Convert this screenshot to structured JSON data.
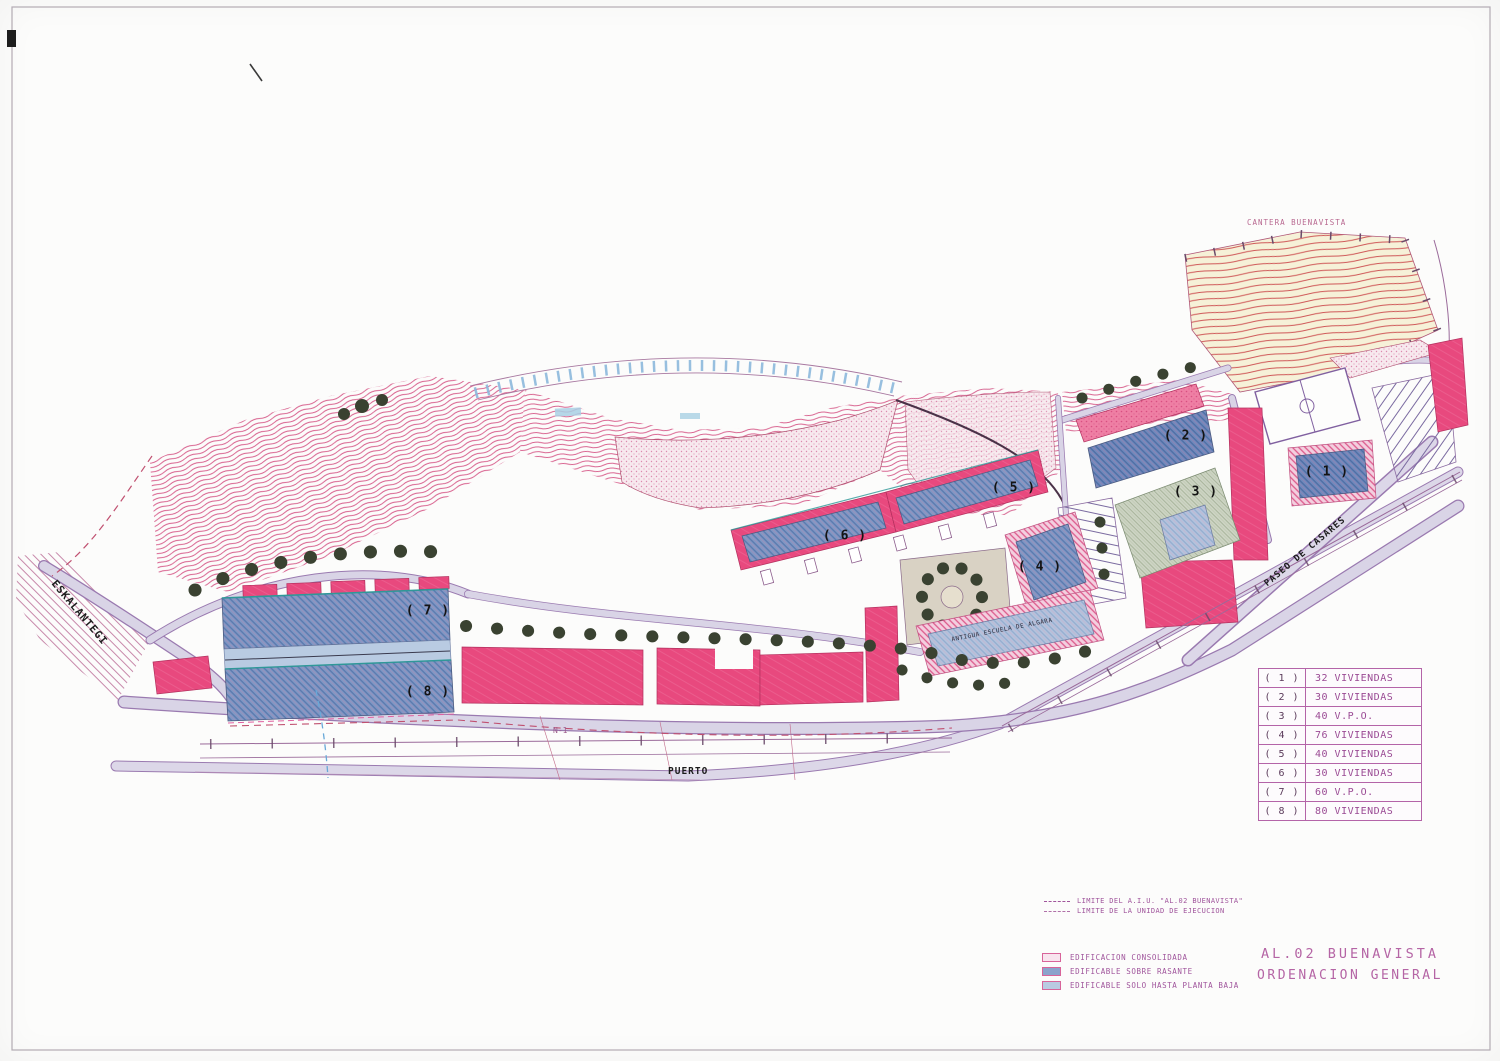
{
  "sheet": {
    "title_line1": "AL.02 BUENAVISTA",
    "title_line2": "ORDENACION GENERAL"
  },
  "map_labels": {
    "cantera_buenavista": "CANTERA BUENAVISTA",
    "eskalantegi": "ESKALANTEGI",
    "paseo_de_casares": "PASEO DE CASARES",
    "puerto": "PUERTO",
    "road_n1": "N-1",
    "building_label": "ANTIGUA ESCUELA DE ALGARA"
  },
  "markers": [
    {
      "label": "( 1 )"
    },
    {
      "label": "( 2 )"
    },
    {
      "label": "( 3 )"
    },
    {
      "label": "( 4 )"
    },
    {
      "label": "( 5 )"
    },
    {
      "label": "( 6 )"
    },
    {
      "label": "( 7 )"
    },
    {
      "label": "( 8 )"
    }
  ],
  "units_table": {
    "rows": [
      {
        "num": "( 1 )",
        "value": "32 VIVIENDAS"
      },
      {
        "num": "( 2 )",
        "value": "30 VIVIENDAS"
      },
      {
        "num": "( 3 )",
        "value": "40 V.P.O."
      },
      {
        "num": "( 4 )",
        "value": "76 VIVIENDAS"
      },
      {
        "num": "( 5 )",
        "value": "40 VIVIENDAS"
      },
      {
        "num": "( 6 )",
        "value": "30 VIVIENDAS"
      },
      {
        "num": "( 7 )",
        "value": "60 V.P.O."
      },
      {
        "num": "( 8 )",
        "value": "80 VIVIENDAS"
      }
    ]
  },
  "line_legend": [
    {
      "label": "LIMITE DEL A.I.U. \"AL.02 BUENAVISTA\""
    },
    {
      "label": "LIMITE DE LA UNIDAD DE EJECUCION"
    }
  ],
  "fill_legend": [
    {
      "label": "EDIFICACION CONSOLIDADA",
      "swatch": "#f8e4ee"
    },
    {
      "label": "EDIFICABLE SOBRE RASANTE",
      "swatch": "#8ba3cc"
    },
    {
      "label": "EDIFICABLE SOLO HASTA PLANTA BAJA",
      "swatch": "#b9cbe2"
    }
  ],
  "colors": {
    "consolidated_building": "#e8497e",
    "buildable_block": "#7e98c4",
    "buildable_ground_floor": "#b9cbe2",
    "contour_line": "#d8618e",
    "quarry_line": "#cf5858",
    "road_fill": "#d9d4e6",
    "tree": "#3a4231",
    "legend_text": "#a0559c",
    "title_text": "#b565a5"
  }
}
